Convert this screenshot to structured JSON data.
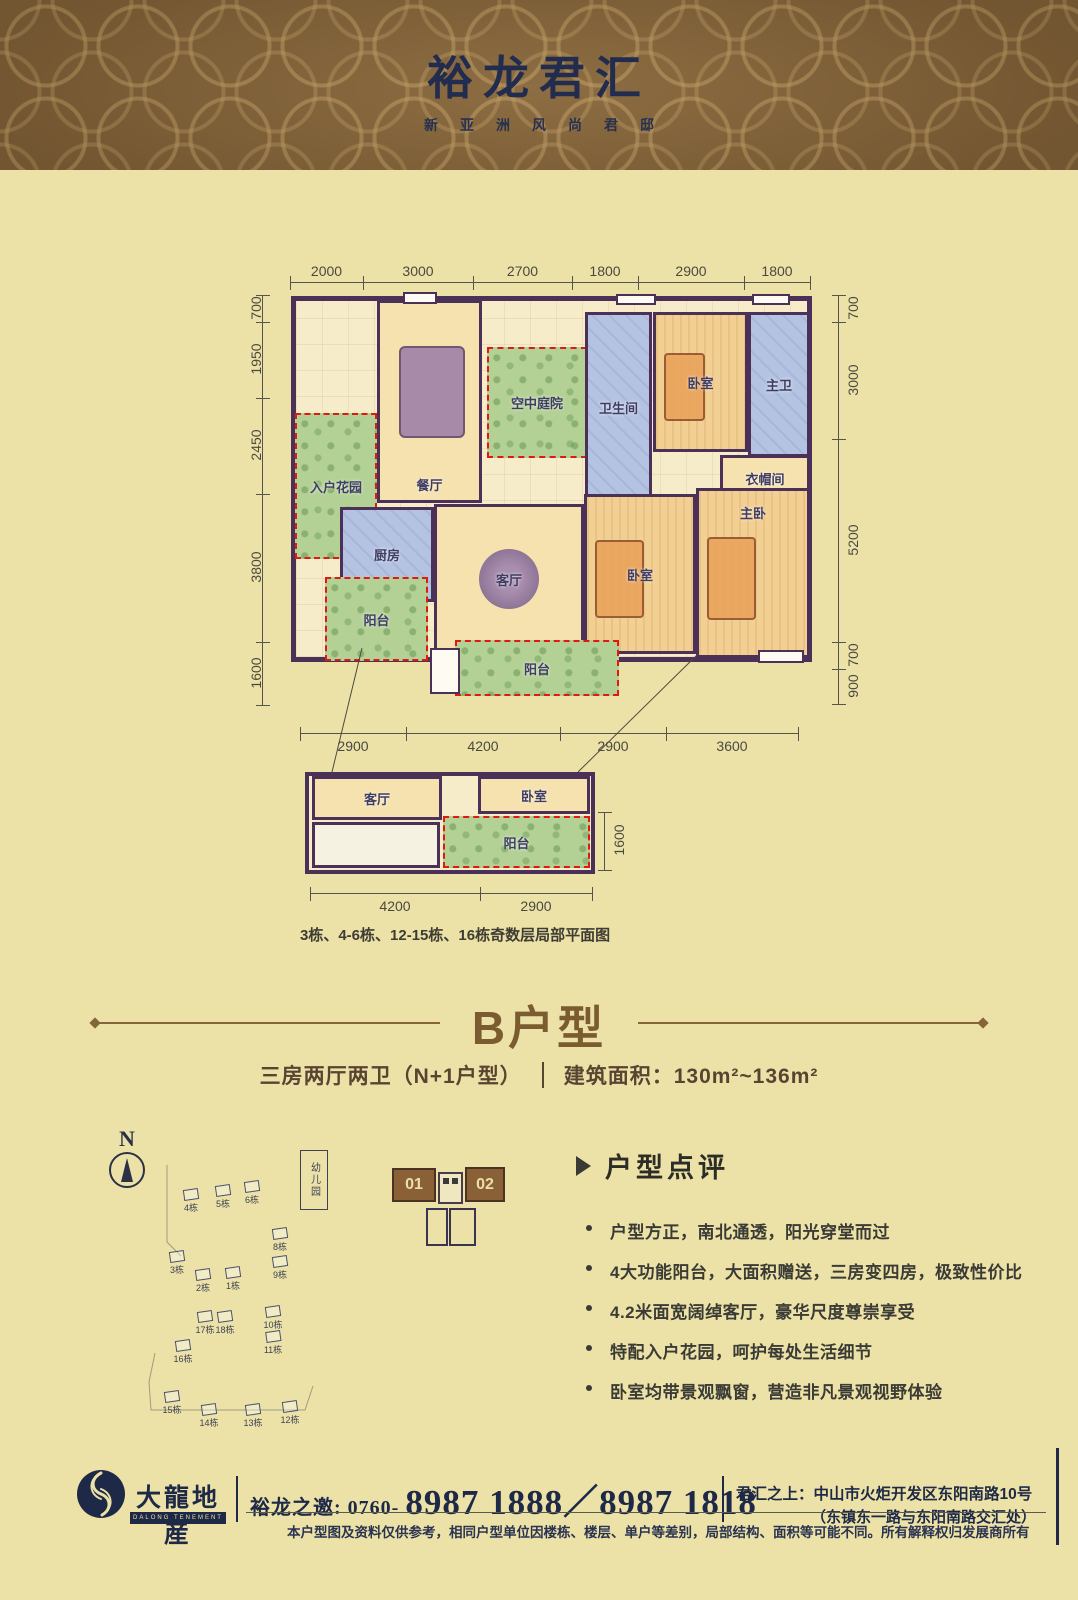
{
  "header": {
    "title": "裕龙君汇",
    "subtitle": "新亚洲风尚君邸"
  },
  "plan": {
    "caption": "3栋、4-6栋、12-15栋、16栋奇数层局部平面图",
    "dims": [
      {
        "label": "2000",
        "x": 290,
        "y": 282,
        "w": 73,
        "cls": "dim-h"
      },
      {
        "label": "3000",
        "x": 363,
        "y": 282,
        "w": 110,
        "cls": "dim-h"
      },
      {
        "label": "2700",
        "x": 473,
        "y": 282,
        "w": 99,
        "cls": "dim-h"
      },
      {
        "label": "1800",
        "x": 572,
        "y": 282,
        "w": 66,
        "cls": "dim-h"
      },
      {
        "label": "2900",
        "x": 638,
        "y": 282,
        "w": 106,
        "cls": "dim-h"
      },
      {
        "label": "1800",
        "x": 744,
        "y": 282,
        "w": 66,
        "cls": "dim-h"
      },
      {
        "label": "700",
        "x": 262,
        "y": 295,
        "h": 27,
        "cls": "dim-v"
      },
      {
        "label": "1950",
        "x": 262,
        "y": 322,
        "h": 76,
        "cls": "dim-v"
      },
      {
        "label": "2450",
        "x": 262,
        "y": 398,
        "h": 96,
        "cls": "dim-v"
      },
      {
        "label": "3800",
        "x": 262,
        "y": 494,
        "h": 148,
        "cls": "dim-v"
      },
      {
        "label": "1600",
        "x": 262,
        "y": 642,
        "h": 63,
        "cls": "dim-v"
      },
      {
        "label": "700",
        "x": 838,
        "y": 295,
        "h": 27,
        "cls": "dim-v lbl-right"
      },
      {
        "label": "3000",
        "x": 838,
        "y": 322,
        "h": 117,
        "cls": "dim-v lbl-right"
      },
      {
        "label": "5200",
        "x": 838,
        "y": 439,
        "h": 203,
        "cls": "dim-v lbl-right"
      },
      {
        "label": "700",
        "x": 838,
        "y": 642,
        "h": 27,
        "cls": "dim-v lbl-right"
      },
      {
        "label": "900",
        "x": 838,
        "y": 669,
        "h": 35,
        "cls": "dim-v lbl-right"
      },
      {
        "label": "2900",
        "x": 300,
        "y": 733,
        "w": 106,
        "cls": "dim-h lbl-below"
      },
      {
        "label": "4200",
        "x": 406,
        "y": 733,
        "w": 154,
        "cls": "dim-h lbl-below"
      },
      {
        "label": "2900",
        "x": 560,
        "y": 733,
        "w": 106,
        "cls": "dim-h lbl-below"
      },
      {
        "label": "3600",
        "x": 666,
        "y": 733,
        "w": 132,
        "cls": "dim-h lbl-below"
      }
    ],
    "rooms": [
      {
        "label": "入户花园",
        "x": 295,
        "y": 413,
        "w": 82,
        "h": 146,
        "cls": "green dashed"
      },
      {
        "label": "餐厅",
        "x": 377,
        "y": 300,
        "w": 105,
        "h": 203,
        "cls": "warm has-table lbl-bottom"
      },
      {
        "label": "空中庭院",
        "x": 487,
        "y": 347,
        "w": 100,
        "h": 111,
        "cls": "green dashed"
      },
      {
        "label": "卫生间",
        "x": 585,
        "y": 312,
        "w": 67,
        "h": 190,
        "cls": "blue"
      },
      {
        "label": "卧室",
        "x": 653,
        "y": 312,
        "w": 95,
        "h": 140,
        "cls": "warm2 has-bed"
      },
      {
        "label": "主卫",
        "x": 748,
        "y": 312,
        "w": 62,
        "h": 145,
        "cls": "blue"
      },
      {
        "label": "衣帽间",
        "x": 720,
        "y": 455,
        "w": 90,
        "h": 46,
        "cls": "warm"
      },
      {
        "label": "厨房",
        "x": 340,
        "y": 507,
        "w": 94,
        "h": 95,
        "cls": "blue"
      },
      {
        "label": "客厅",
        "x": 434,
        "y": 504,
        "w": 150,
        "h": 150,
        "cls": "warm has-rug"
      },
      {
        "label": "阳台",
        "x": 325,
        "y": 577,
        "w": 103,
        "h": 84,
        "cls": "green dashed"
      },
      {
        "label": "卧室",
        "x": 584,
        "y": 494,
        "w": 112,
        "h": 160,
        "cls": "warm2 has-bed"
      },
      {
        "label": "主卧",
        "x": 696,
        "y": 488,
        "w": 114,
        "h": 170,
        "cls": "warm2 has-bed lbl-top"
      },
      {
        "label": "阳台",
        "x": 455,
        "y": 640,
        "w": 164,
        "h": 56,
        "cls": "green dashed"
      },
      {
        "x": 403,
        "y": 292,
        "w": 34,
        "h": 12,
        "cls": "win"
      },
      {
        "x": 616,
        "y": 294,
        "w": 40,
        "h": 11,
        "cls": "win"
      },
      {
        "x": 752,
        "y": 294,
        "w": 38,
        "h": 11,
        "cls": "win"
      },
      {
        "x": 430,
        "y": 648,
        "w": 30,
        "h": 46,
        "cls": "win"
      },
      {
        "x": 758,
        "y": 650,
        "w": 46,
        "h": 13,
        "cls": "win"
      }
    ],
    "small_rooms": [
      {
        "label": "客厅",
        "x": 312,
        "y": 776,
        "w": 130,
        "h": 44,
        "cls": "warm"
      },
      {
        "label": "卧室",
        "x": 478,
        "y": 776,
        "w": 112,
        "h": 38,
        "cls": "warm"
      },
      {
        "label": "阳台",
        "x": 443,
        "y": 816,
        "w": 147,
        "h": 52,
        "cls": "green dashed"
      },
      {
        "x": 312,
        "y": 822,
        "w": 128,
        "h": 46,
        "cls": "blank"
      }
    ],
    "small_dims": [
      {
        "label": "4200",
        "x": 310,
        "y": 893,
        "w": 170,
        "cls": "dim-h lbl-below"
      },
      {
        "label": "2900",
        "x": 480,
        "y": 893,
        "w": 112,
        "cls": "dim-h lbl-below"
      },
      {
        "label": "1600",
        "x": 604,
        "y": 812,
        "h": 58,
        "cls": "dim-v lbl-right"
      }
    ]
  },
  "section": {
    "title": "B户型",
    "spec": "三房两厅两卫（N+1户型）",
    "area": "建筑面积：130m²~136m²"
  },
  "siteplan": {
    "north": "N",
    "kindergarten": "幼儿园",
    "buildings": [
      {
        "label": "4栋",
        "x": 96,
        "y": 69
      },
      {
        "label": "5栋",
        "x": 128,
        "y": 65
      },
      {
        "label": "6栋",
        "x": 157,
        "y": 61
      },
      {
        "label": "3栋",
        "x": 82,
        "y": 131
      },
      {
        "label": "2栋",
        "x": 108,
        "y": 149
      },
      {
        "label": "1栋",
        "x": 138,
        "y": 147
      },
      {
        "label": "8栋",
        "x": 185,
        "y": 108
      },
      {
        "label": "9栋",
        "x": 185,
        "y": 136
      },
      {
        "label": "17栋",
        "x": 110,
        "y": 191
      },
      {
        "label": "18栋",
        "x": 130,
        "y": 191
      },
      {
        "label": "10栋",
        "x": 178,
        "y": 186
      },
      {
        "label": "11栋",
        "x": 178,
        "y": 211
      },
      {
        "label": "16栋",
        "x": 88,
        "y": 220
      },
      {
        "label": "15栋",
        "x": 77,
        "y": 271
      },
      {
        "label": "14栋",
        "x": 114,
        "y": 284
      },
      {
        "label": "13栋",
        "x": 158,
        "y": 284
      },
      {
        "label": "12栋",
        "x": 195,
        "y": 281
      }
    ]
  },
  "units": {
    "b1": "01",
    "b2": "02"
  },
  "review": {
    "heading": "户型点评",
    "bullets": [
      "户型方正，南北通透，阳光穿堂而过",
      "4大功能阳台，大面积赠送，三房变四房，极致性价比",
      "4.2米面宽阔绰客厅，豪华尺度尊崇享受",
      "特配入户花园，呵护每处生活细节",
      "卧室均带景观飘窗，营造非凡景观视野体验"
    ]
  },
  "footer": {
    "brand": "大龍地産",
    "brand_en": "DALONG TENEMENT",
    "phone_label": "裕龙之邀: 0760-",
    "phone_numbers": "8987 1888／8987 1818",
    "address1": "君汇之上：中山市火炬开发区东阳南路10号",
    "address2": "（东镇东一路与东阳南路交汇处）",
    "disclaimer": "本户型图及资料仅供参考，相同户型单位因楼栋、楼层、单户等差别，局部结构、面积等可能不同。所有解释权归发展商所有"
  }
}
